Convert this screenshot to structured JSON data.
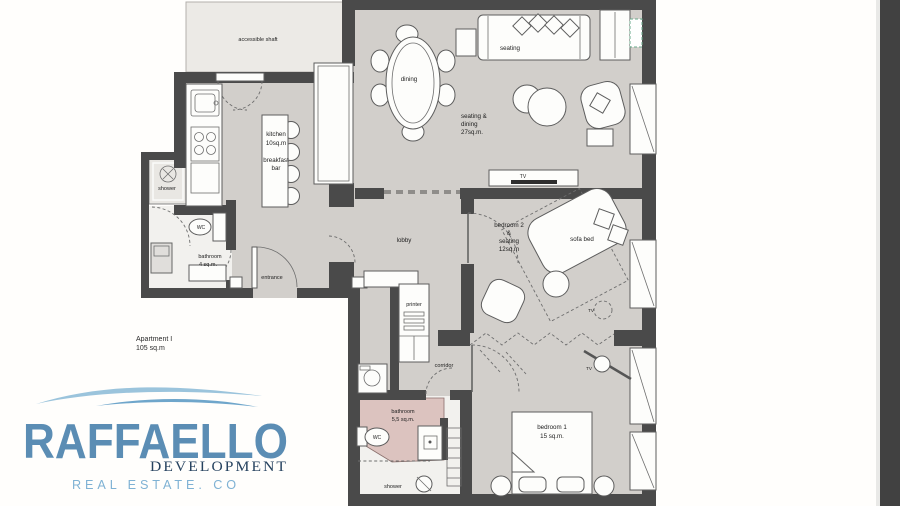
{
  "canvas": {
    "background": "#fffefc",
    "side_strip_color": "#414141"
  },
  "plan": {
    "title": {
      "line1": "Apartment I",
      "line2": "105 sq.m"
    },
    "colors": {
      "wall": "#4a4a4a",
      "floor": "#d2cfcb",
      "shaft": "#eceae6",
      "wet_floor": "#f2f1ee",
      "bathroom_pink": "#dcc3bf",
      "ac_green": "#69a98b"
    },
    "labels": {
      "shaft": "accessible shaft",
      "kitchen": [
        "kitchen",
        "10sq.m",
        "breakfast",
        "bar"
      ],
      "dining": "dining",
      "seating": "seating",
      "living": [
        "seating &",
        "dining",
        "27sq.m."
      ],
      "tv": "TV",
      "shower": "shower",
      "wc": "WC",
      "bathroom_small": [
        "bathroom",
        "4 sq.m."
      ],
      "entrance": "entrance",
      "lobby": "lobby",
      "bedroom2": [
        "bedroom 2",
        "&",
        "seating",
        "12sq.m"
      ],
      "sofa_bed": "sofa bed",
      "printer": "printer",
      "corridor": "corridor",
      "bathroom_main": [
        "bathroom",
        "5,5 sq.m."
      ],
      "bedroom1": [
        "bedroom 1",
        "15 sq.m."
      ]
    }
  },
  "logo": {
    "brand": "RAFFAELLO",
    "division": "DEVELOPMENT",
    "tagline": "REAL ESTATE. CO",
    "colors": {
      "brand": "#5b8db4",
      "division": "#26425f",
      "tagline": "#7fb2d4",
      "swoosh": "#9bc4dc",
      "swoosh_dark": "#6fa6cb"
    }
  }
}
